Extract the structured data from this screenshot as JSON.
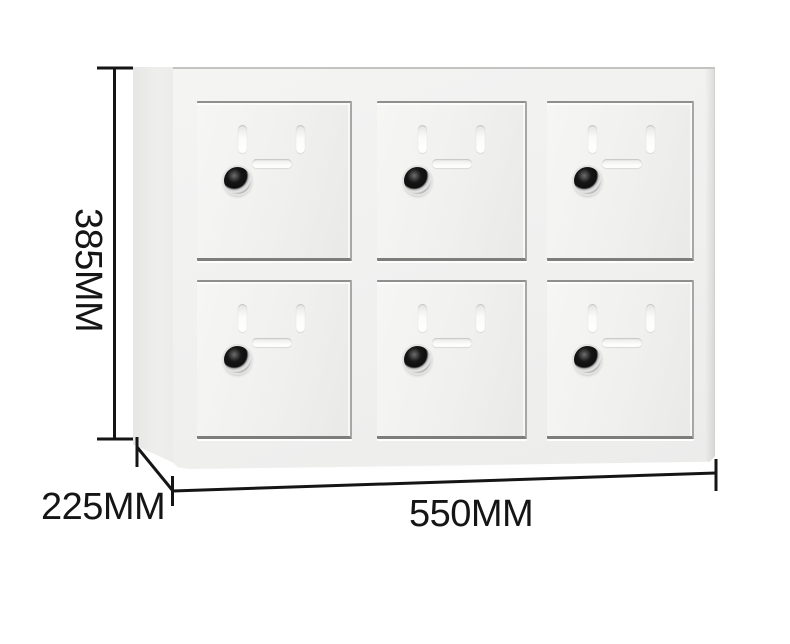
{
  "canvas": {
    "width": 790,
    "height": 644,
    "background": "#ffffff"
  },
  "product": {
    "type": "six-door-metal-locker",
    "rows": 2,
    "columns": 3,
    "door_count": 6,
    "door_features": {
      "vertical_vent_slots": 2,
      "horizontal_vent_slot": 1,
      "cam_lock": 1
    },
    "colors": {
      "cabinet_body": "#f2f2f1",
      "door_face": "#f1f1f0",
      "side_panel": "#e9e9e8",
      "door_gap_shadow": "#8f8f8e",
      "lock_black": "#141414",
      "lock_ring": "#d9d9d9"
    }
  },
  "dimensions": {
    "height_label": "385MM",
    "depth_label": "225MM",
    "width_label": "550MM",
    "line_color": "#151515"
  }
}
